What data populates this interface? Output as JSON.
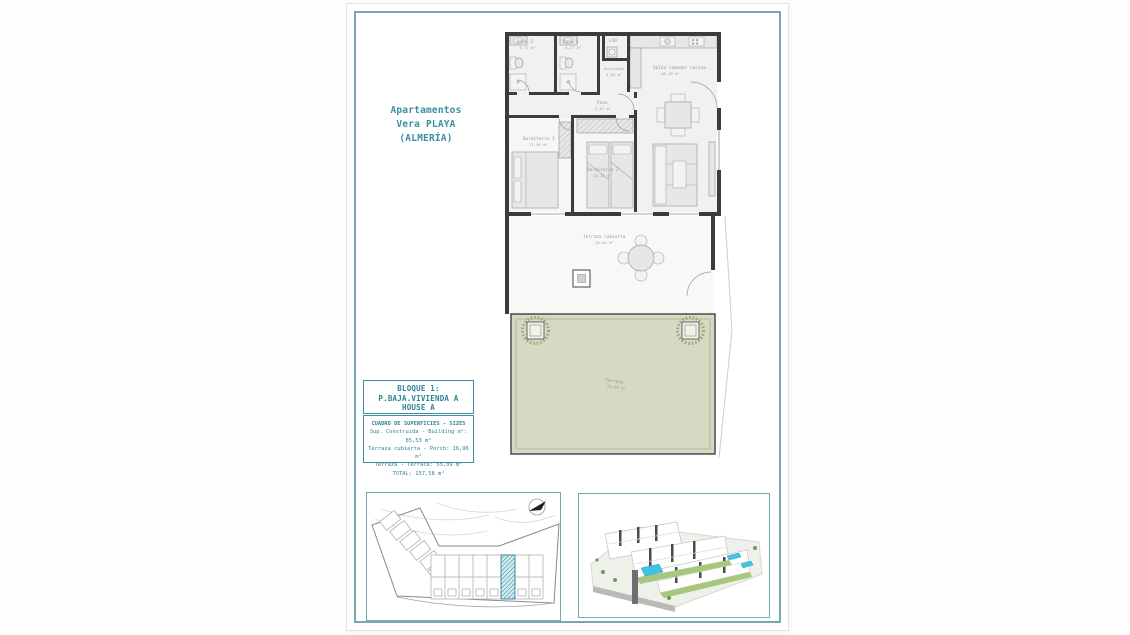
{
  "sheet": {
    "project_title": [
      "Apartamentos",
      "Vera PLAYA",
      "(ALMERÍA)"
    ],
    "title_block": [
      "BLOQUE 1:",
      "P.BAJA.VIVIENDA A",
      "HOUSE A"
    ],
    "surface_table": {
      "header": "CUADRO DE SUPERFICIES - SIZES",
      "rows": [
        "Sup. Construida - Building m²: 85,53 m²",
        "Terraza cubierta - Porch: 16,96 m²",
        "Terraza - Terrace: 55,09 m²"
      ],
      "total": "TOTAL: 157,58 m²"
    }
  },
  "floor_plan": {
    "rooms": {
      "bano2": {
        "name": "Baño 2",
        "area": "3,71 m²"
      },
      "bano1": {
        "name": "Baño 1",
        "area": "4,17 m²"
      },
      "lvd": {
        "name": "LVD"
      },
      "recibidor": {
        "name": "Recibidor",
        "area": "3,94 m²"
      },
      "salon": {
        "name": "Salón comedor cocina",
        "area": "26,10 m²"
      },
      "paso": {
        "name": "Paso",
        "area": "2,01 m²"
      },
      "dormitorio1": {
        "name": "Dormitorio 1",
        "area": "11,96 m²"
      },
      "dormitorio2": {
        "name": "Dormitorio 2",
        "area": "10,24 m²"
      },
      "terraza_cubierta": {
        "name": "Terraza cubierta",
        "area": "16,96 m²"
      },
      "terraza": {
        "name": "Terraza",
        "area": "55,09 m²"
      }
    }
  },
  "colors": {
    "accent_teal": "#3a8fa0",
    "frame_teal": "#76a8b3",
    "wall_dark": "#3c3c3c",
    "terrace_green": "#d7d9c5",
    "pool_blue": "#41c3e4",
    "site_highlight": "#3f96a8"
  }
}
